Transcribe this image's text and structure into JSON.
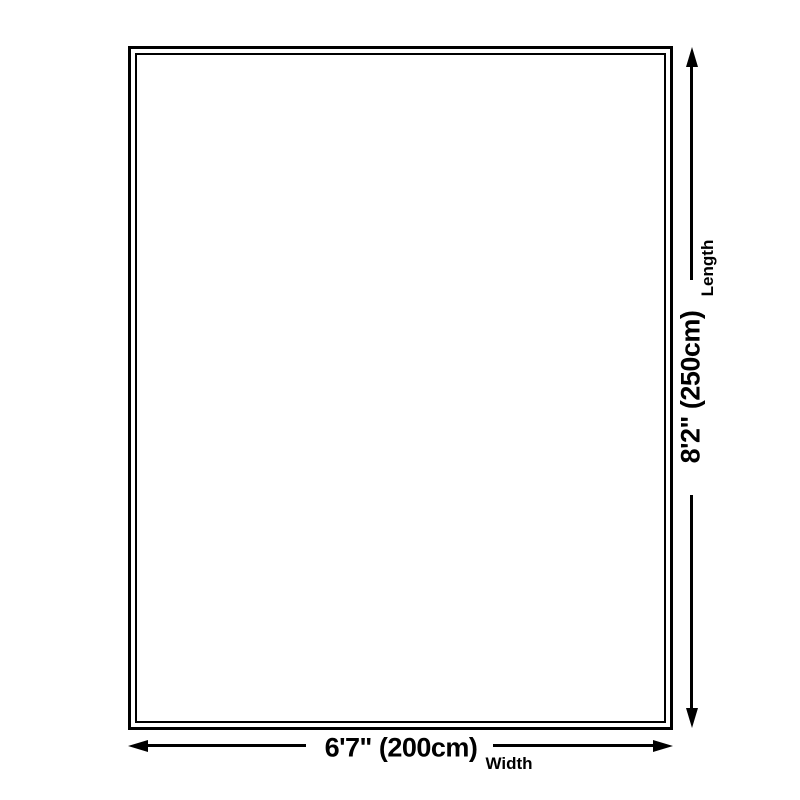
{
  "diagram": {
    "width_dimension": {
      "value": "6'7\" (200cm)",
      "label": "Width"
    },
    "length_dimension": {
      "value": "8'2\" (250cm)",
      "label": "Length"
    },
    "colors": {
      "line": "#000000",
      "background": "#ffffff"
    }
  }
}
